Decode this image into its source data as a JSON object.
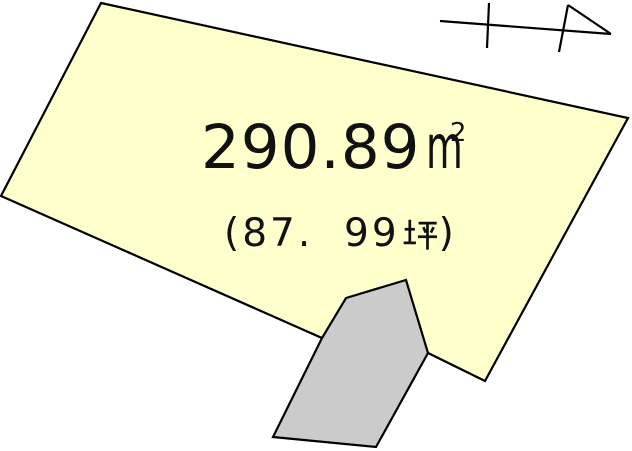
{
  "diagram": {
    "background_color": "#ffffff",
    "outline_color": "#000000",
    "text_color": "#111111",
    "parcel": {
      "fill_color": "#ffffcc",
      "points": "101,3 628,118 485,381 428,353 322,338 1,196",
      "area_sqm_value": "290.89",
      "area_sqm_unit_base": "m",
      "area_sqm_unit_exponent": "2",
      "area_tsubo_open_paren": "(",
      "area_tsubo_value": "87.  99",
      "area_tsubo_unit": "坪",
      "area_tsubo_close_paren": ")"
    },
    "building": {
      "fill_color": "#cbcbcb",
      "points": "346,298 406,280 428,353 376,447 273,437 322,338"
    },
    "north_arrow": {
      "path": "M440,21 L611,34 M489,3 L487,48 M568,5 L559,52 M568,5 L611,34"
    }
  }
}
